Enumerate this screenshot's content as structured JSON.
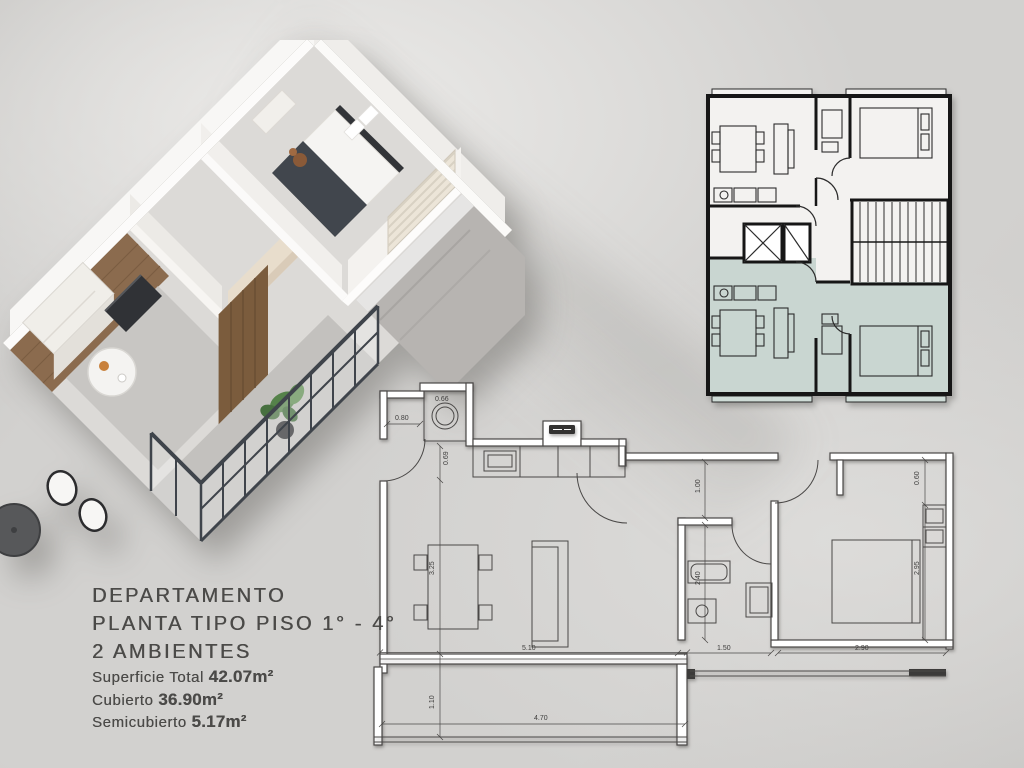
{
  "info": {
    "title_line1": "DEPARTAMENTO",
    "title_line2": "PLANTA TIPO PISO 1° - 4°",
    "title_line3": "2 AMBIENTES",
    "areas": [
      {
        "label": "Superficie Total",
        "value": "42.07m²"
      },
      {
        "label": "Cubierto",
        "value": "36.90m²"
      },
      {
        "label": "Semicubierto",
        "value": "5.17m²"
      }
    ]
  },
  "floorplan": {
    "dims": {
      "entry_width": "0.80",
      "laundry_machine": "0.66",
      "kitchen_aisle": "0.69",
      "hall_width": "1.00",
      "living_depth": "3.25",
      "living_width": "5.10",
      "balcony_depth": "1.10",
      "balcony_width": "4.70",
      "bath_depth": "2.40",
      "bath_width": "1.50",
      "closet_width": "0.60",
      "bedroom_depth": "2.95",
      "bedroom_width": "2.90"
    }
  },
  "keyplan": {
    "highlight_color": "#c9d6d1"
  },
  "colors": {
    "background": "#d2d1cf",
    "plan_line": "#4a4847",
    "highlight": "#c9d6d1",
    "wood": "#7b5c3d",
    "railing": "#3f444b"
  }
}
